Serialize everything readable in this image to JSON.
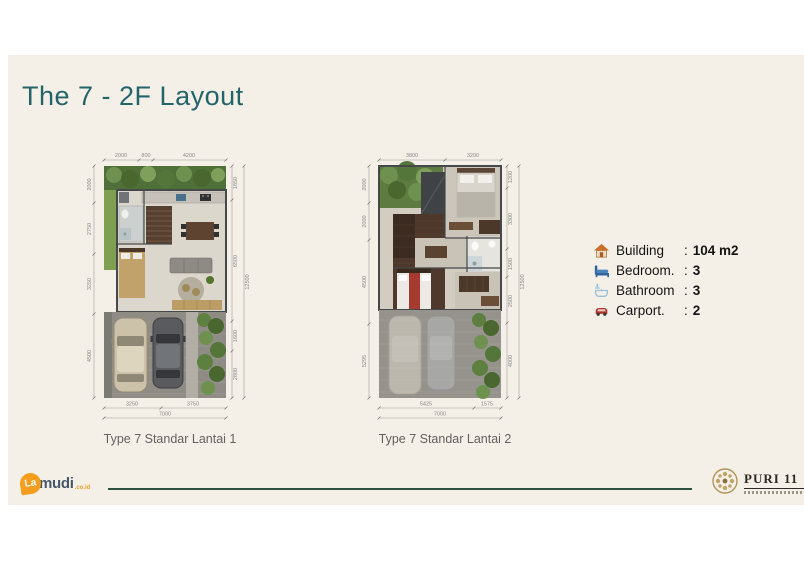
{
  "slide": {
    "title": "The 7 - 2F Layout"
  },
  "plans": [
    {
      "caption": "Type 7 Standar Lantai 1",
      "dims": {
        "top": [
          "2000",
          "800",
          "4200"
        ],
        "left": [
          "2000",
          "2750",
          "3250",
          "4500"
        ],
        "right": [
          "1850",
          "6500",
          "1600",
          "2800"
        ],
        "right_total": "12500",
        "bottom": [
          "3250",
          "3750"
        ],
        "bottom_total": "7000"
      }
    },
    {
      "caption": "Type 7 Standar Lantai 2",
      "dims": {
        "top": [
          "3800",
          "3200"
        ],
        "left": [
          "2000",
          "2000",
          "4500",
          "5295"
        ],
        "right": [
          "1200",
          "3300",
          "1500",
          "2500",
          "4000"
        ],
        "right_total": "12500",
        "bottom": [
          "5425",
          "1575"
        ],
        "bottom_total": "7000"
      }
    }
  ],
  "specs": [
    {
      "icon": "house-icon",
      "label": "Building",
      "colon": ":",
      "value": "104 m2"
    },
    {
      "icon": "bed-icon",
      "label": "Bedroom.",
      "colon": ":",
      "value": "3"
    },
    {
      "icon": "bathroom-icon",
      "label": "Bathroom",
      "colon": ":",
      "value": "3"
    },
    {
      "icon": "car-icon",
      "label": "Carport.",
      "colon": ":",
      "value": "2"
    }
  ],
  "footer": {
    "lamudi": {
      "part1": "La",
      "part2": "mudi",
      "suffix": ".co.id"
    },
    "puri": {
      "name": "PURI 11"
    }
  },
  "colors": {
    "title_teal": "#23646a",
    "divider_green": "#30503f",
    "gold": "#b3945a",
    "lamudi_orange": "#f59e1e",
    "lamudi_dark": "#46576b",
    "slide_cream": "#f4f0e7"
  }
}
